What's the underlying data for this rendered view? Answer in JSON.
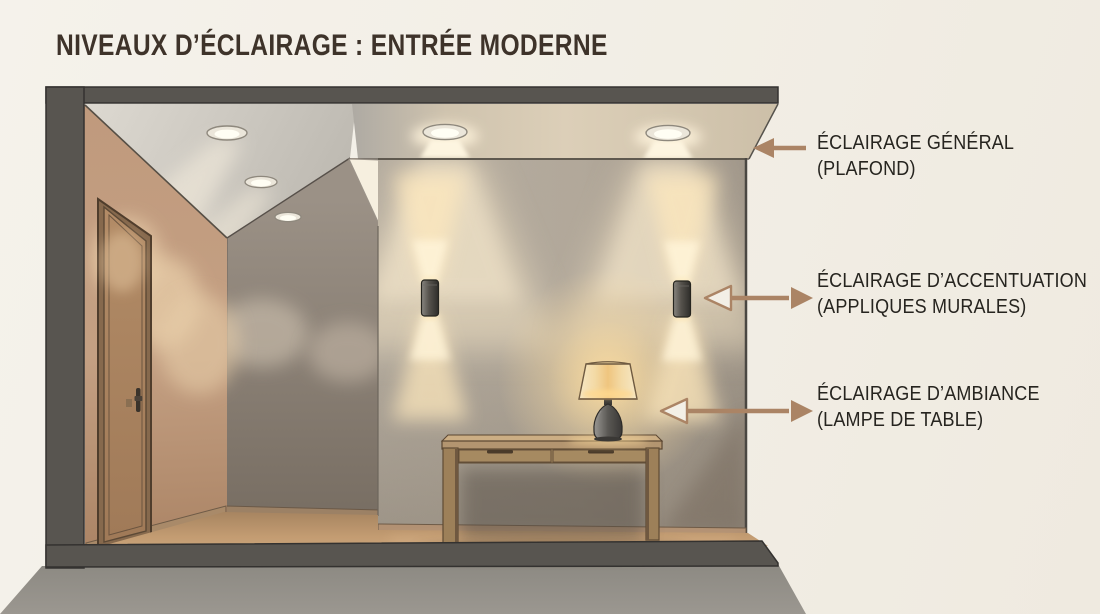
{
  "title": "NIVEAUX D’ÉCLAIRAGE : ENTRÉE MODERNE",
  "annotations": [
    {
      "line1": "ÉCLAIRAGE GÉNÉRAL",
      "line2": "(PLAFOND)",
      "target": "ceiling-downlights",
      "arrow_style": "solid-head-left"
    },
    {
      "line1": "ÉCLAIRAGE D’ACCENTUATION",
      "line2": "(APPLIQUES MURALES)",
      "target": "wall-sconces",
      "arrow_style": "open-head-left-solid-head-right"
    },
    {
      "line1": "ÉCLAIRAGE D’AMBIANCE",
      "line2": "(LAMPE DE TABLE)",
      "target": "table-lamp",
      "arrow_style": "open-head-left-solid-head-right"
    }
  ],
  "scene": {
    "corridor_downlights": 3,
    "soffit_downlights": 2,
    "wall_sconces": 2,
    "table_drawers": 2,
    "doors": 1
  },
  "colors": {
    "background": "#f2eee5",
    "frame_slab": "#585550",
    "cast_shadow": "#918e87",
    "arrow": "#ab8465",
    "title_text": "#3e332a",
    "label_text": "#26241f",
    "warm_light": "#ffe3a6",
    "floor": "#c39c72",
    "feature_wall": "#b3a99b",
    "left_wall": "#c29d80"
  }
}
